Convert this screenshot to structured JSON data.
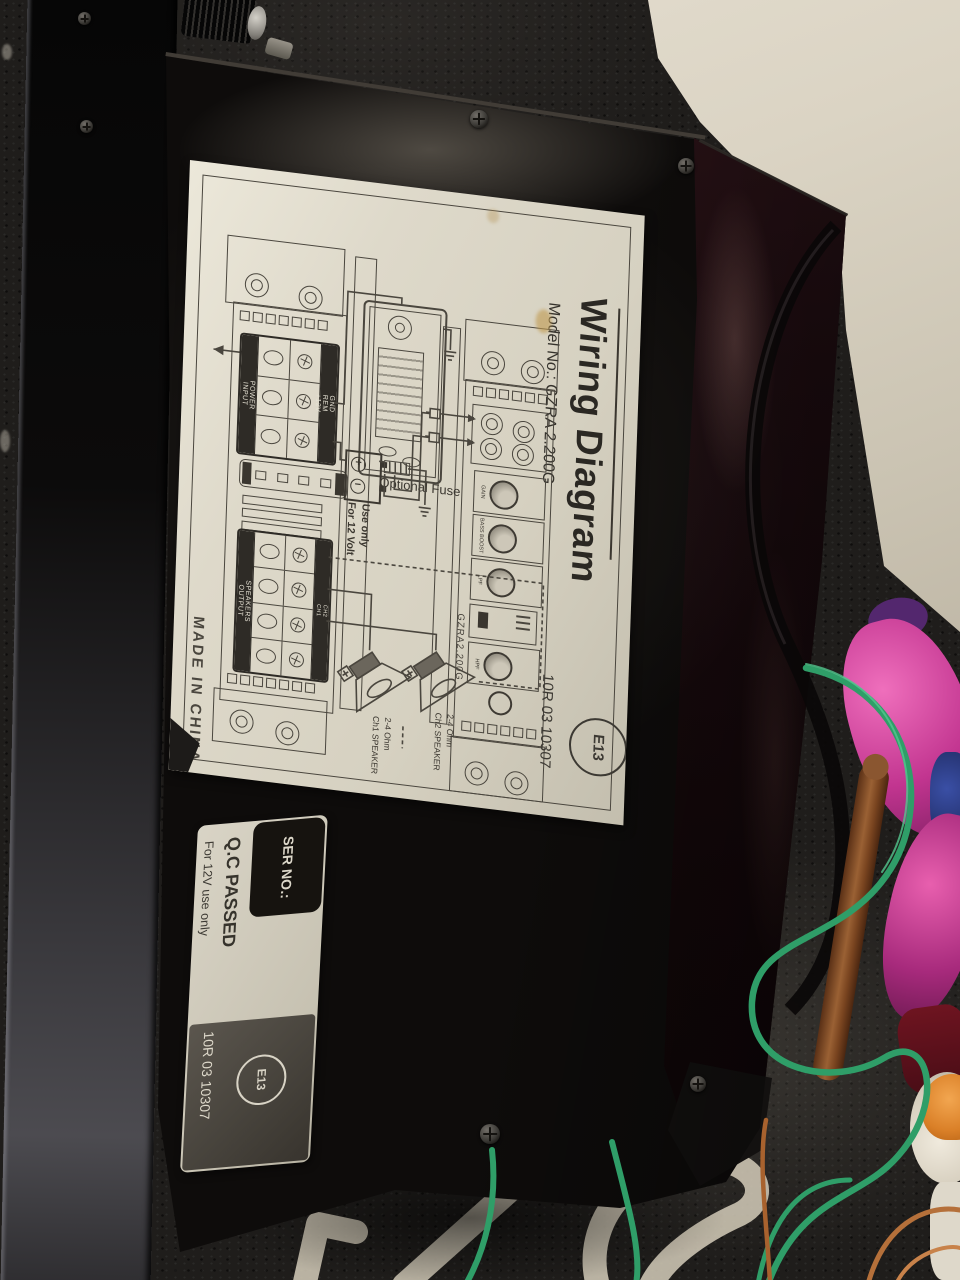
{
  "wiring_label": {
    "title": "Wiring Diagram",
    "model_line": "Model No.: GZRA 2.200G",
    "optional_fuse_label": "Optional Fuse",
    "battery_note": [
      "For 12 Volt",
      "Use only"
    ],
    "made_in": "MADE IN CHINA",
    "approval_number": "10R 03 10307",
    "e_mark": "E13",
    "amp_body_model": "GZRA2.200G",
    "power_block": {
      "side_labels": [
        "POWER",
        "INPUT"
      ],
      "terminal_labels": [
        "GND",
        "REM",
        "+12V"
      ]
    },
    "speaker_block": {
      "side_labels": [
        "SPEAKERS",
        "OUTPUT"
      ],
      "channel_labels": [
        "CH2",
        "CH1"
      ]
    },
    "controls": {
      "knob1": "GAIN",
      "knob2": "BASS BOOST",
      "knob3": "LPF",
      "switch": "X-OVER",
      "knob4": "HPF",
      "port": "REM"
    },
    "speaker1": [
      "Ch1 SPEAKER",
      "2-4 Ohm"
    ],
    "speaker2": [
      "Ch2 SPEAKER",
      "2-4 Ohm"
    ]
  },
  "qc_sticker": {
    "ser_no": "SER NO.:",
    "qc_passed": "Q.C PASSED",
    "use_note": "For 12V use only",
    "approval_number": "10R 03 10307",
    "e_mark": "E13"
  },
  "colors": {
    "label_bg": "#ddd8ca",
    "line_ink": "#4a463e",
    "amp_black": "#0e0c0b",
    "carpet": "#201e1c",
    "floor": "#d9d2c2",
    "green_wire": "#2f9e68",
    "copper_wire": "#b5703a",
    "pink_fabric": "#c23590"
  }
}
